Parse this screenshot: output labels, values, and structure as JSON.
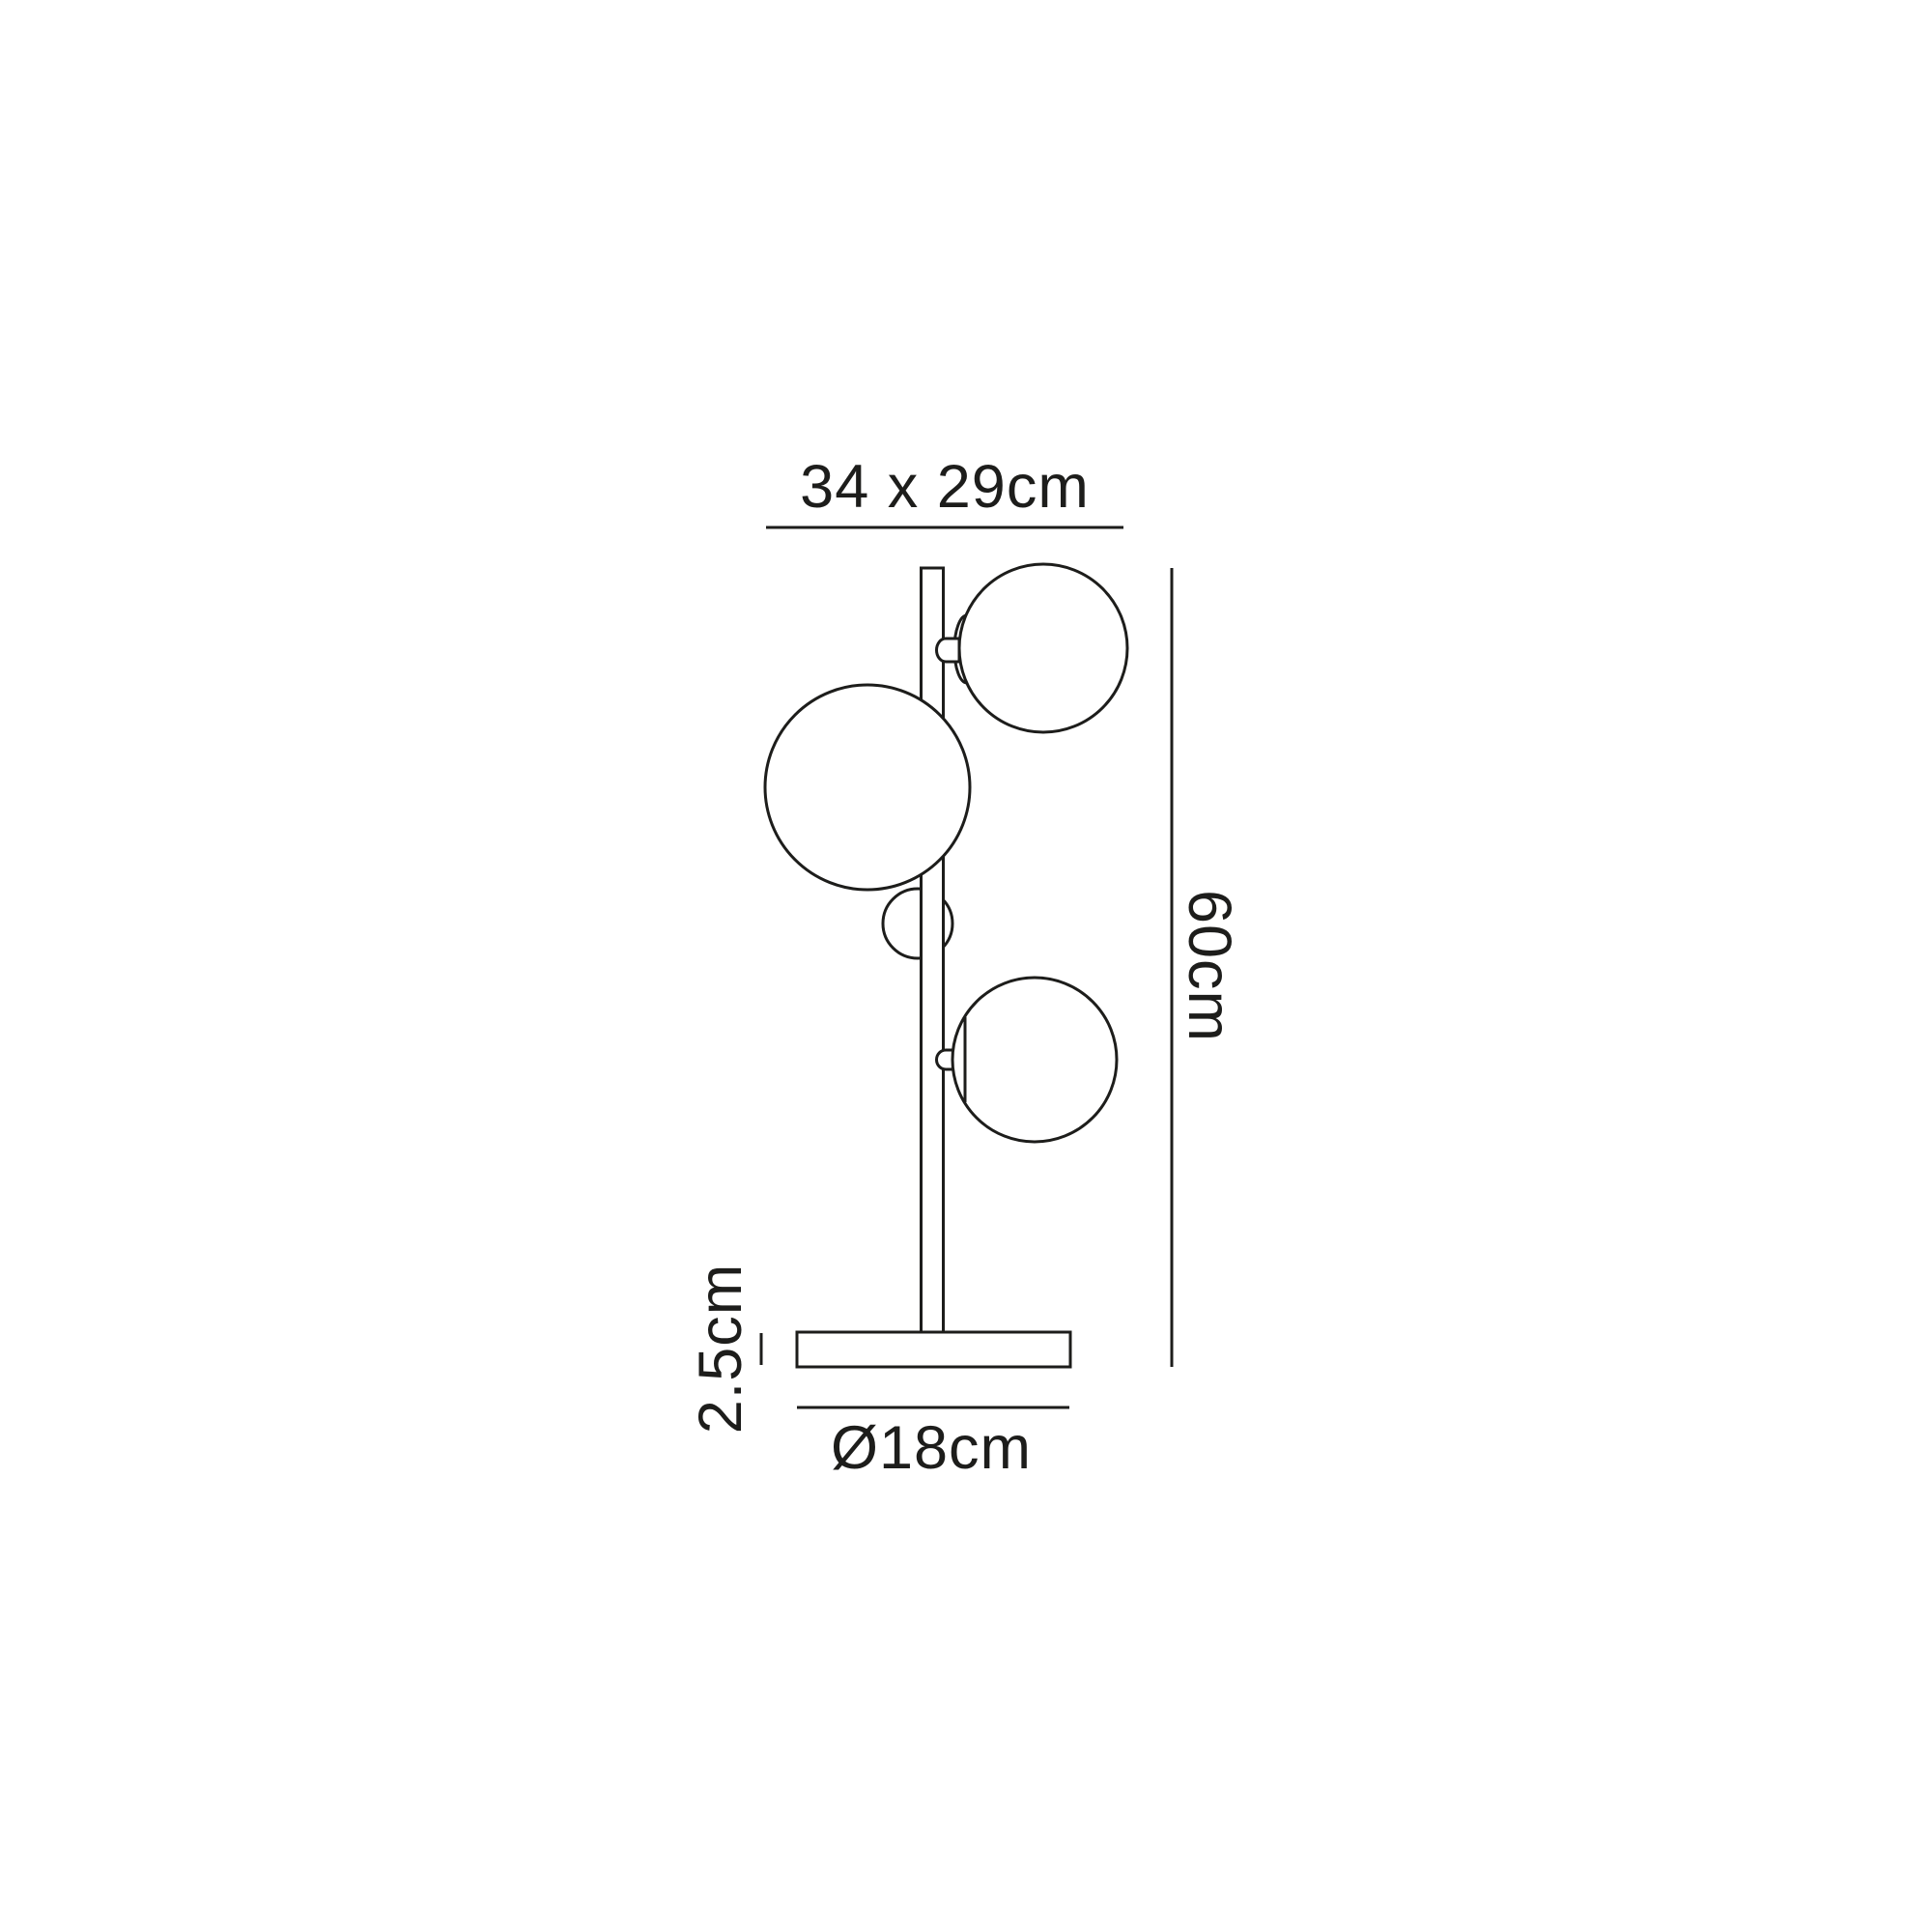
{
  "page": {
    "background_color": "#ffffff"
  },
  "diagram": {
    "type": "product-dimension-drawing",
    "subject": "three-globe table lamp",
    "line_color": "#1d1d1b",
    "text_color": "#1d1d1b",
    "labels": {
      "width_depth": "34 x 29cm",
      "height": "60cm",
      "base_height": "2.5cm",
      "base_diameter": "Ø18cm"
    }
  }
}
